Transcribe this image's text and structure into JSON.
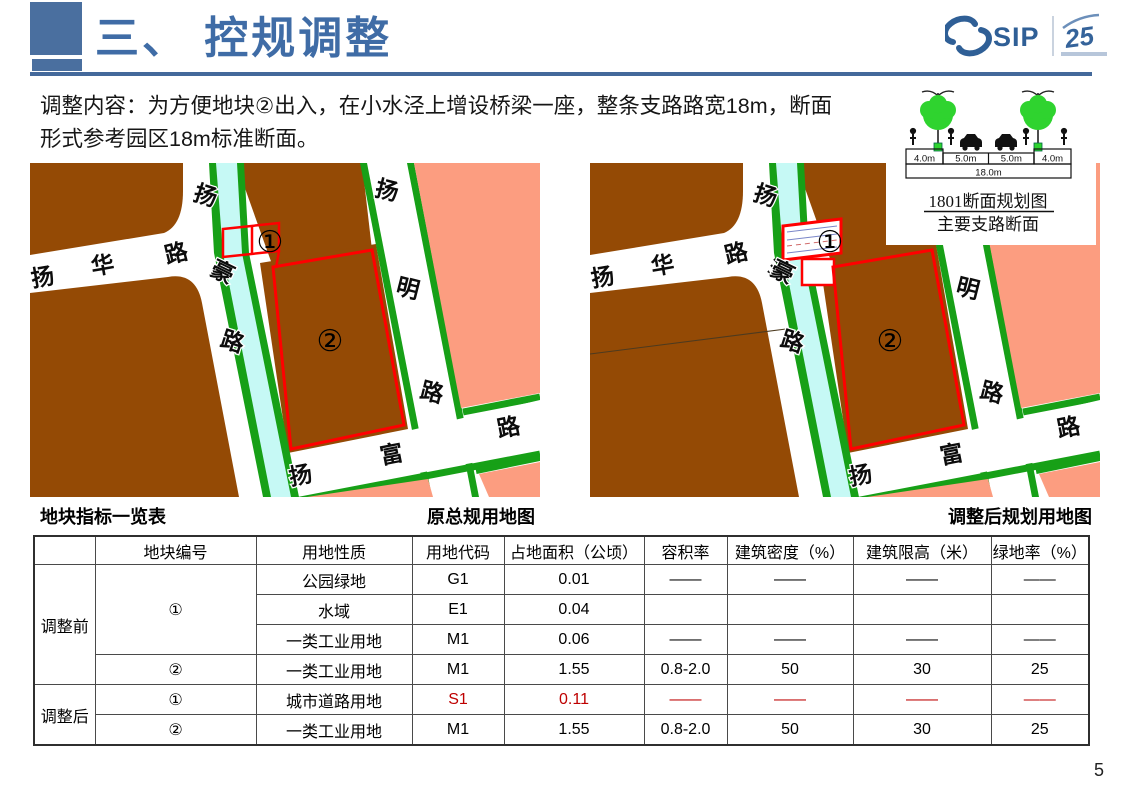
{
  "header": {
    "title": "三、 控规调整"
  },
  "logo": {
    "sip": "SIP",
    "anniversary": "25"
  },
  "description": {
    "line1": "调整内容：为方便地块②出入，在小水泾上增设桥梁一座，整条支路路宽18m，断面",
    "line2": "形式参考园区18m标准断面。"
  },
  "section_diagram": {
    "dims": [
      "4.0m",
      "5.0m",
      "5.0m",
      "4.0m"
    ],
    "total": "18.0m",
    "caption1": "1801断面规划图",
    "caption2": "主要支路断面"
  },
  "maps": {
    "left_caption": "原总规用地图",
    "right_caption": "调整后规划用地图",
    "roads": {
      "yanghua": [
        "扬",
        "华",
        "路"
      ],
      "yanghao": [
        "扬",
        "豪",
        "路"
      ],
      "yangming": [
        "扬",
        "明",
        "路"
      ],
      "yangfu": [
        "扬",
        "富",
        "路"
      ]
    },
    "labels": {
      "parcel1": "①",
      "parcel2": "②"
    }
  },
  "table": {
    "caption": "地块指标一览表",
    "headers": [
      "",
      "地块编号",
      "用地性质",
      "用地代码",
      "占地面积（公顷）",
      "容积率",
      "建筑密度（%）",
      "建筑限高（米）",
      "绿地率（%）"
    ],
    "rows": [
      {
        "group": "调整前",
        "parcel": "①",
        "use": "公园绿地",
        "code": "G1",
        "area": "0.01",
        "far": "——",
        "density": "——",
        "height": "——",
        "green": "——"
      },
      {
        "use": "水域",
        "code": "E1",
        "area": "0.04",
        "far": "",
        "density": "",
        "height": "",
        "green": ""
      },
      {
        "use": "一类工业用地",
        "code": "M1",
        "area": "0.06",
        "far": "——",
        "density": "——",
        "height": "——",
        "green": "——"
      },
      {
        "parcel": "②",
        "use": "一类工业用地",
        "code": "M1",
        "area": "1.55",
        "far": "0.8-2.0",
        "density": "50",
        "height": "30",
        "green": "25"
      },
      {
        "group": "调整后",
        "parcel": "①",
        "use": "城市道路用地",
        "code": "S1",
        "area": "0.11",
        "far": "——",
        "density": "——",
        "height": "——",
        "green": "——"
      },
      {
        "parcel": "②",
        "use": "一类工业用地",
        "code": "M1",
        "area": "1.55",
        "far": "0.8-2.0",
        "density": "50",
        "height": "30",
        "green": "25"
      }
    ]
  },
  "page_number": "5",
  "colors": {
    "accent_blue": "#4a6f9f",
    "title_blue": "#3f6ca6",
    "parcel_brown": "#944a05",
    "parcel_pink": "#fc9d80",
    "greenery": "#17a017",
    "river_cyan": "#c6f9f5",
    "outline_red": "#ff0000",
    "table_highlight_red": "#be0000"
  }
}
